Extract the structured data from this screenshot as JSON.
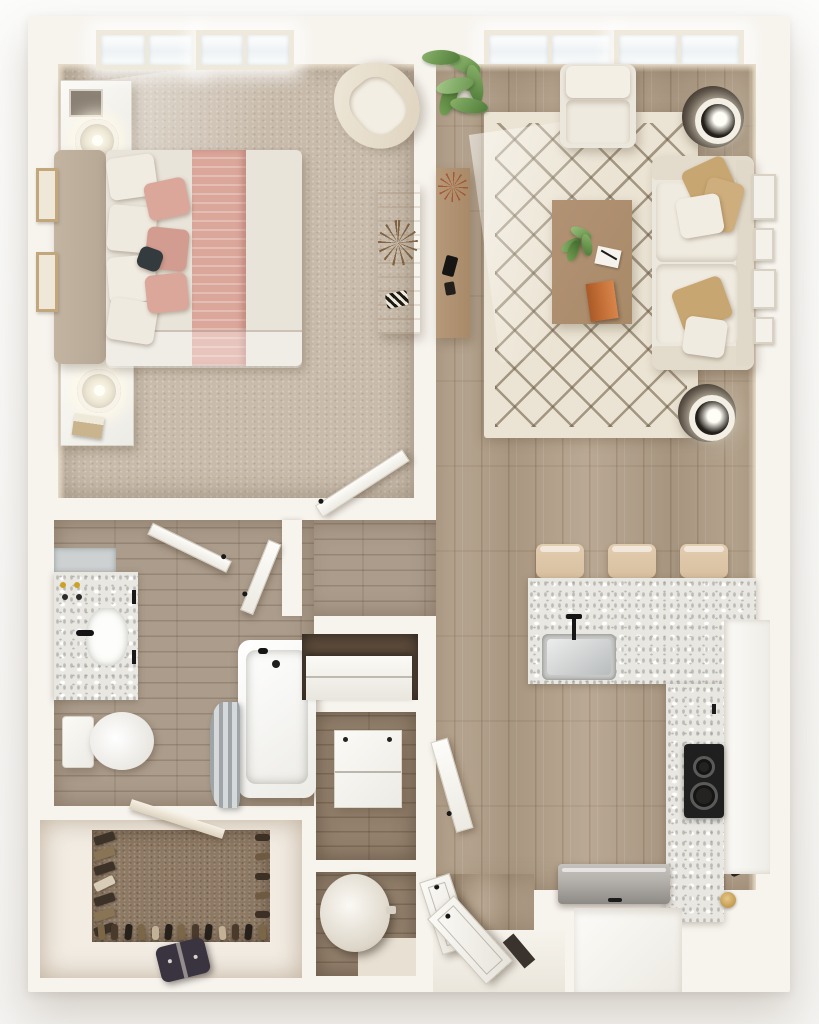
{
  "scene": {
    "kind": "3d-floor-plan-render",
    "view": "top-down",
    "unit_type": "one-bedroom apartment",
    "visible_text": "none"
  },
  "palette": {
    "wall": "#f7f4ee",
    "wall_face": "#e7dcc9",
    "carpet": "#c8bbab",
    "closet_carpet": "#8e7a64",
    "wood": "#b3a089",
    "tile": "#ab9c8c",
    "dark_wood": "#93816d",
    "rug": "#ebe3d3",
    "marble": "#e9e7e1",
    "upholstery": "#ece7dd",
    "pillow_tan": "#c8a671",
    "bed_linen": "#e9e4da",
    "bed_blush": "#dba79b",
    "headboard": "#b7a896",
    "wood_furniture": "#a88a68",
    "bench_wood": "#d2b183",
    "stool_tan": "#d8c0a0",
    "dark_table": "#3a322b",
    "cooktop": "#201f1f",
    "appliance_gray": "#b5b1ac",
    "curtain_gray": "#bfc3c4",
    "plant_green": "#6f9c55",
    "book_orange": "#c06b33",
    "accent_pillow_dark": "#343b3e",
    "bag_dark": "#3a3340"
  },
  "rooms": [
    {
      "id": "bedroom",
      "floor": "carpet",
      "contents": [
        "bed",
        "blush-bedding",
        "nightstand-with-lamp",
        "nightstand-with-lamp",
        "accent-chair",
        "wood-bench",
        "dried-plant",
        "wall-art",
        "windows"
      ]
    },
    {
      "id": "living-room",
      "floor": "wood",
      "contents": [
        "sofa",
        "throw-pillows",
        "armchair",
        "round-side-table-lamp",
        "round-side-table-lamp",
        "coffee-table",
        "trellis-rug",
        "media-console",
        "potted-plant",
        "gallery-frames",
        "windows"
      ]
    },
    {
      "id": "kitchen",
      "floor": "wood",
      "contents": [
        "l-shaped-quartz-counter",
        "bar-stools",
        "sink",
        "cooktop",
        "refrigerator",
        "cabinet"
      ]
    },
    {
      "id": "bathroom",
      "floor": "tile",
      "contents": [
        "marble-vanity",
        "sink",
        "toilet",
        "bathtub",
        "shower-curtain",
        "door"
      ]
    },
    {
      "id": "walk-in-closet",
      "floor": "carpet",
      "contents": [
        "hanging-clothes",
        "shoe-rows",
        "duffel-bag"
      ]
    },
    {
      "id": "hall",
      "floor": "tile",
      "contents": [
        "door",
        "door"
      ]
    },
    {
      "id": "linen-closet",
      "floor": "wood",
      "contents": [
        "shelf"
      ]
    },
    {
      "id": "laundry-closet",
      "floor": "wood",
      "contents": [
        "washer-dryer"
      ]
    },
    {
      "id": "utility-closet",
      "floor": "wood",
      "contents": [
        "water-heater"
      ]
    },
    {
      "id": "entry",
      "floor": "wood",
      "contents": [
        "closet-doors",
        "front-door"
      ]
    }
  ],
  "counts": {
    "bar_stools": 3,
    "sofa_seat_cushions": 2,
    "sofa_pillows": 5,
    "bed_pillows": 8,
    "closet_shoes_bottom": 13,
    "closet_shoes_right": 5,
    "closet_hanging_clothes": 7,
    "gallery_frames": 4,
    "bedroom_wall_frames": 2,
    "bedroom_window_units": 2,
    "living_window_units": 2,
    "cooktop_burners": 2
  }
}
